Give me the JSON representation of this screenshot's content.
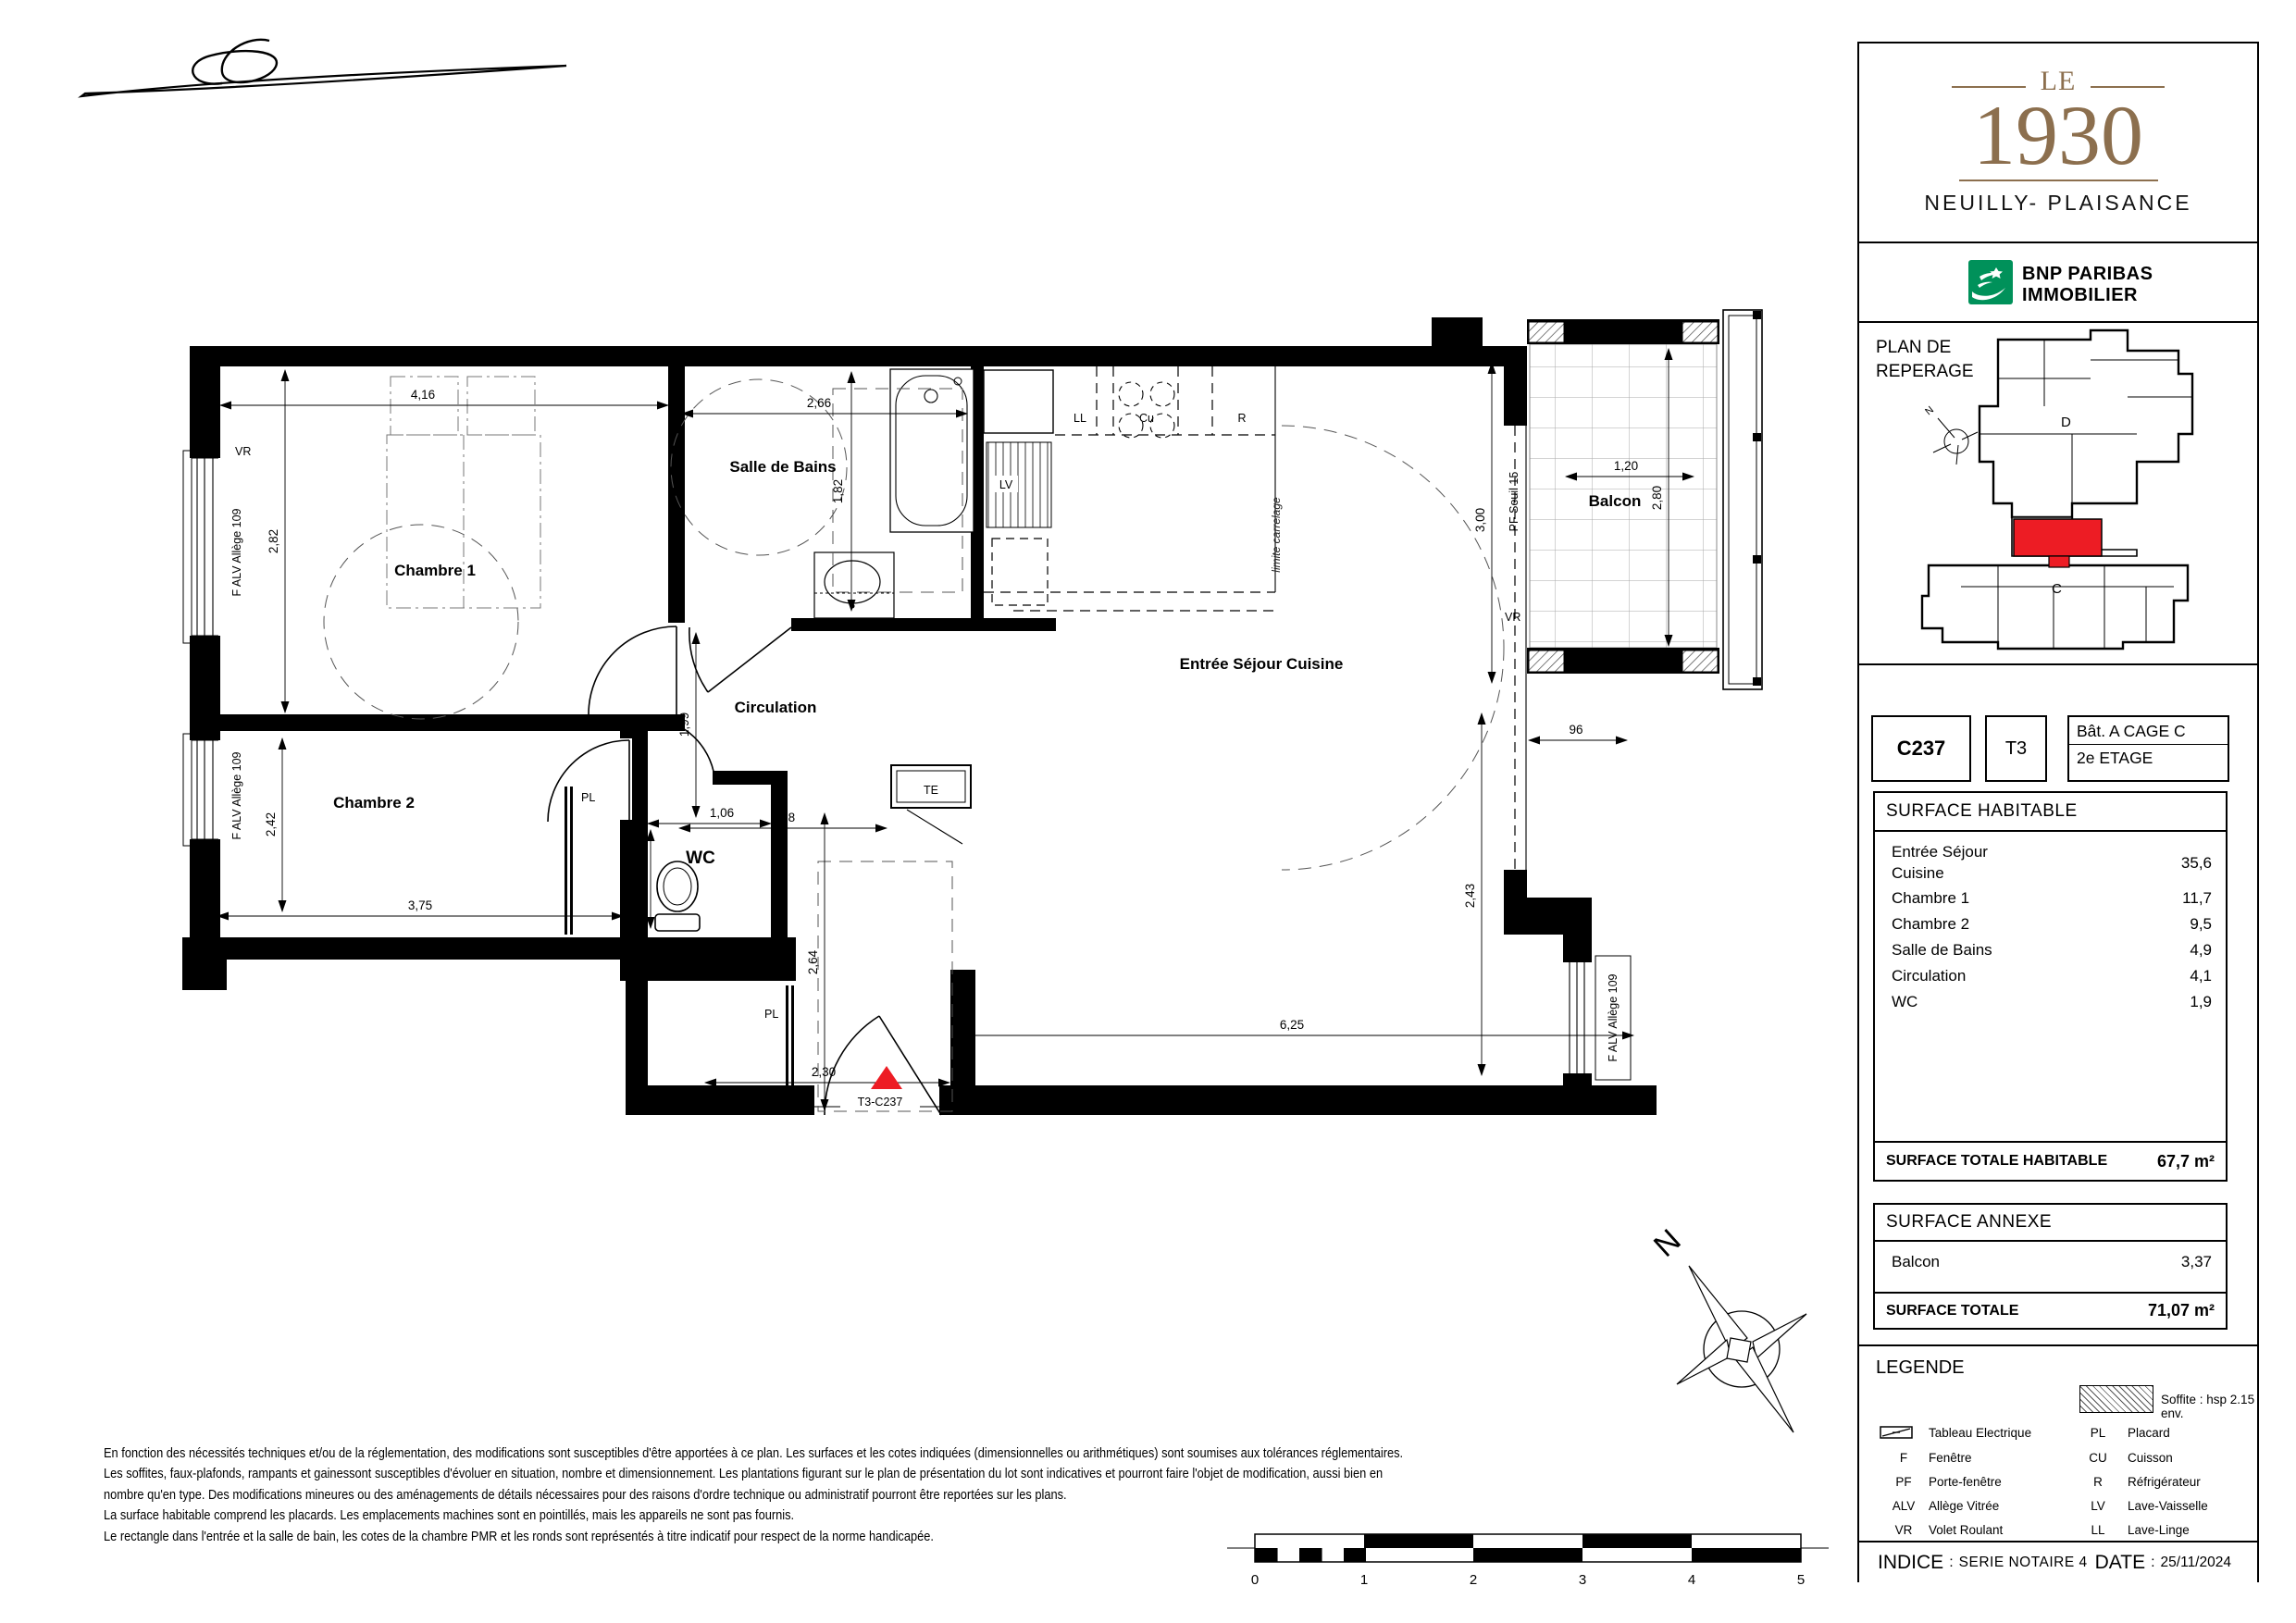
{
  "project": {
    "logo_top": "LE",
    "logo_year": "1930",
    "city": "NEUILLY- PLAISANCE"
  },
  "agency": {
    "line1": "BNP PARIBAS",
    "line2": "IMMOBILIER"
  },
  "reperage": {
    "title_line1": "PLAN DE",
    "title_line2": "REPERAGE",
    "cage_c": "C",
    "cage_d": "D",
    "north": "N"
  },
  "unit": {
    "code": "C237",
    "type": "T3",
    "building": "Bât. A  CAGE C",
    "floor": "2e ETAGE"
  },
  "surface_habitable": {
    "title": "SURFACE HABITABLE",
    "rows": [
      {
        "label": "Entrée Séjour",
        "label2": "Cuisine",
        "value": "35,6"
      },
      {
        "label": "Chambre 1",
        "value": "11,7"
      },
      {
        "label": "Chambre 2",
        "value": "9,5"
      },
      {
        "label": "Salle de Bains",
        "value": "4,9"
      },
      {
        "label": "Circulation",
        "value": "4,1"
      },
      {
        "label": "WC",
        "value": "1,9"
      }
    ],
    "total_label": "SURFACE TOTALE HABITABLE",
    "total_value": "67,7 m²"
  },
  "surface_annexe": {
    "title": "SURFACE ANNEXE",
    "rows": [
      {
        "label": "Balcon",
        "value": "3,37"
      }
    ],
    "total_label": "SURFACE TOTALE",
    "total_value": "71,07 m²"
  },
  "legende": {
    "title": "LEGENDE",
    "soffite": "Soffite : hsp 2.15 env.",
    "items_left": [
      {
        "abbr": "",
        "label": "Tableau Electrique"
      },
      {
        "abbr": "F",
        "label": "Fenêtre"
      },
      {
        "abbr": "PF",
        "label": "Porte-fenêtre"
      },
      {
        "abbr": "ALV",
        "label": "Allège Vitrée"
      },
      {
        "abbr": "VR",
        "label": "Volet Roulant"
      }
    ],
    "items_right": [
      {
        "abbr": "PL",
        "label": "Placard"
      },
      {
        "abbr": "CU",
        "label": "Cuisson"
      },
      {
        "abbr": "R",
        "label": "Réfrigérateur"
      },
      {
        "abbr": "LV",
        "label": "Lave-Vaisselle"
      },
      {
        "abbr": "LL",
        "label": "Lave-Linge"
      }
    ]
  },
  "footer": {
    "indice_label": "INDICE",
    "indice_sep": ":",
    "indice_value": "SERIE NOTAIRE 4",
    "date_label": "DATE",
    "date_sep": ":",
    "date_value": "25/11/2024"
  },
  "disclaimer": [
    "En fonction des nécessités techniques et/ou de la réglementation, des modifications sont susceptibles d'être apportées à ce plan. Les surfaces et les cotes indiquées (dimensionnelles ou arithmétiques) sont soumises aux tolérances réglementaires.",
    "Les soffites, faux-plafonds, rampants et gainessont susceptibles d'évoluer en situation, nombre et dimensionnement. Les plantations figurant sur le plan de présentation du lot sont indicatives et pourront faire l'objet de modification, aussi bien en",
    "nombre qu'en type. Des modifications mineures ou des aménagements de détails nécessaires pour des raisons d'ordre technique ou administratif pourront être reportées sur les plans.",
    "La surface habitable comprend les placards. Les emplacements machines sont en pointillés, mais les appareils ne sont pas fournis.",
    "Le rectangle dans l'entrée et la salle de bain, les cotes de la chambre PMR et les ronds sont représentés à titre indicatif pour respect de la norme handicapée."
  ],
  "plan": {
    "rooms": [
      "Chambre 1",
      "Chambre 2",
      "Salle de Bains",
      "Circulation",
      "WC",
      "Entrée Séjour Cuisine",
      "Balcon"
    ],
    "dims": [
      "4,16",
      "2,66",
      "2,82",
      "1,82",
      "2,42",
      "3,75",
      "1,99",
      "1,98",
      "1,06",
      "1,36",
      "2,64",
      "2,30",
      "6,25",
      "2,43",
      "3,00",
      "1,20",
      "2,80",
      "96"
    ],
    "labels": {
      "vr": "VR",
      "alv": "F ALV Allège 109",
      "pf": "PF Seuil 15",
      "pl": "PL",
      "te": "TE",
      "ll": "LL",
      "cu": "Cu",
      "r": "R",
      "lv": "LV",
      "lim": "limite carrelage",
      "lot": "T3-C237",
      "north": "N"
    },
    "scale_labels": [
      "0",
      "1",
      "2",
      "3",
      "4",
      "5"
    ],
    "colors": {
      "unit_red": "#ed1c24",
      "logo_brown": "#8c6f4e",
      "bnp_green": "#00915a"
    }
  }
}
